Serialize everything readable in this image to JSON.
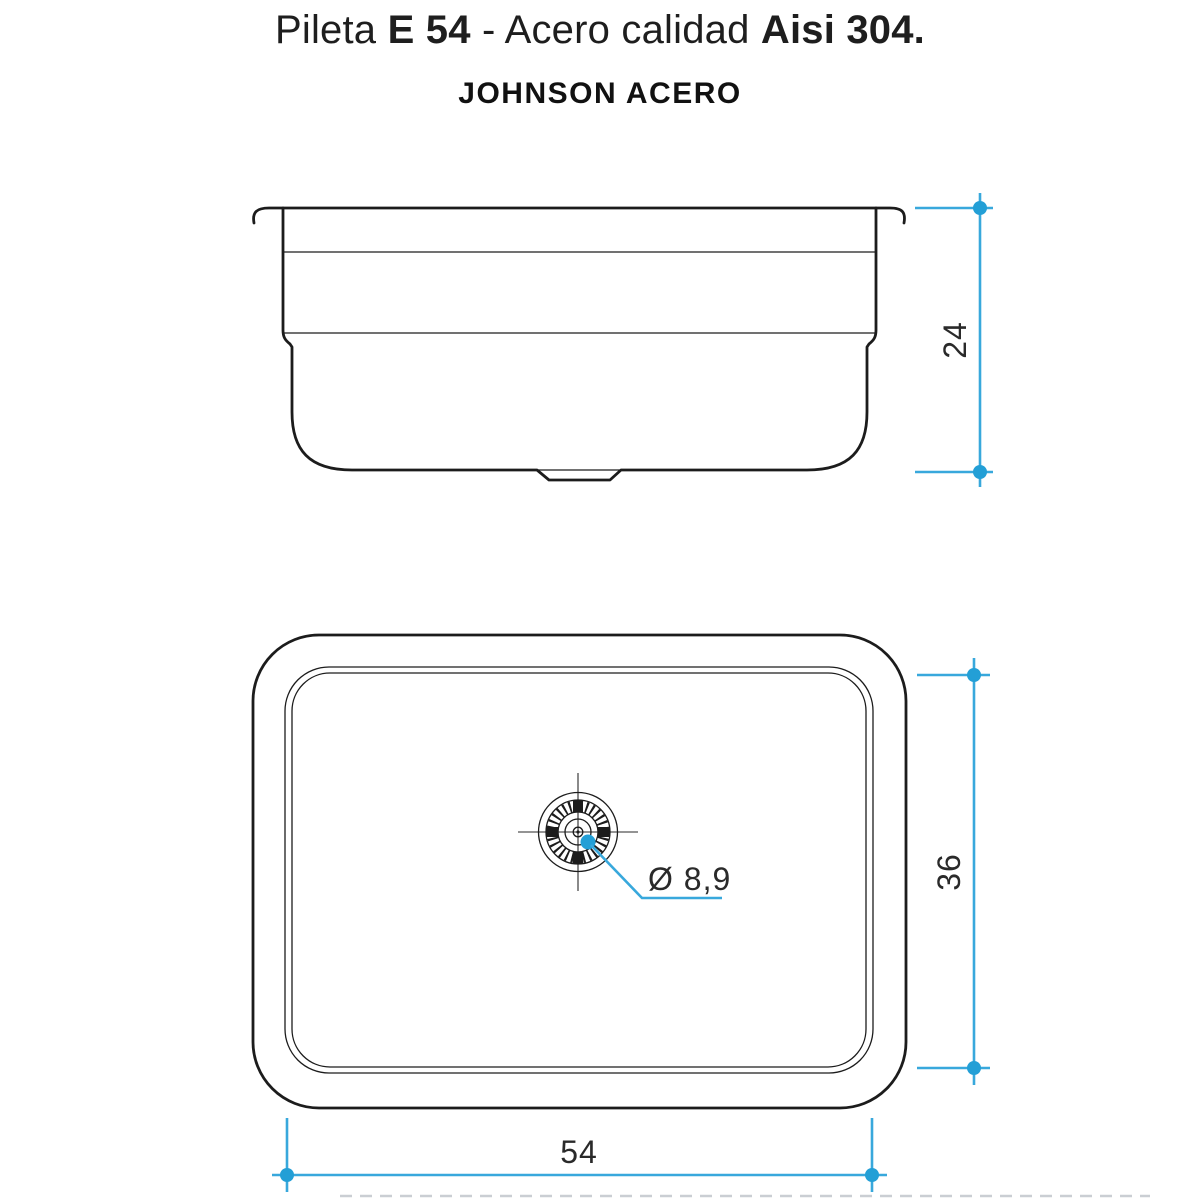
{
  "title": {
    "part1": "Pileta ",
    "part2": "E 54",
    "part3": " - Acero calidad ",
    "part4": "Aisi 304."
  },
  "brand": "JOHNSON ACERO",
  "dimensions": {
    "side_depth": "24",
    "top_height": "36",
    "top_width": "54",
    "drain_diameter": "Ø 8,9"
  },
  "colors": {
    "accent": "#38a8dc",
    "accent_dot": "#239fd6",
    "ink": "#1c1c1c",
    "muted": "#c4c9ce"
  }
}
